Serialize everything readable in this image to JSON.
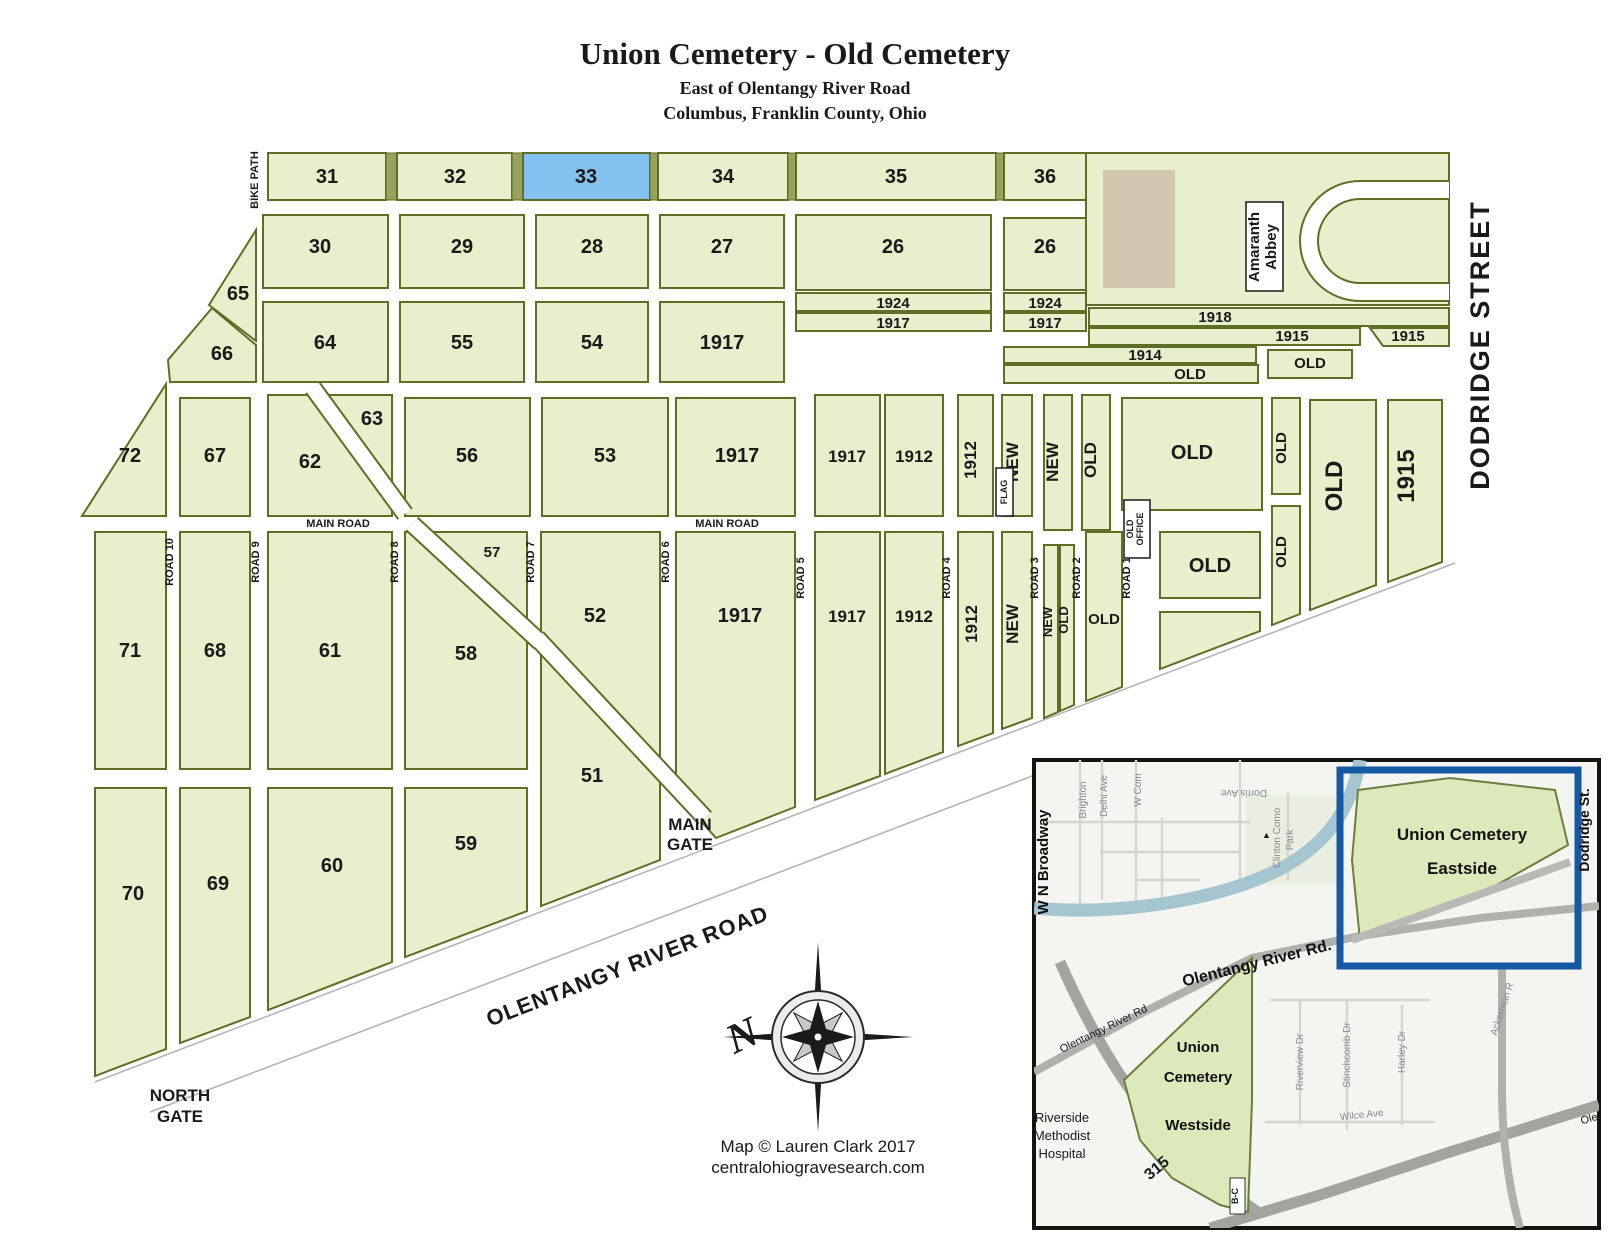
{
  "title": "Union Cemetery - Old Cemetery",
  "subtitle_line1": "East of Olentangy River Road",
  "subtitle_line2": "Columbus, Franklin County, Ohio",
  "colors": {
    "section_fill": "#e9efcd",
    "section_border": "#5f6e24",
    "separator_fill": "#97a35c",
    "highlight_fill": "#85c1ee",
    "building_fill": "#d4c7b2",
    "road_line_gray": "#b5b5b5",
    "inset_frame": "#141414",
    "inset_highlight_blue": "#1559a5",
    "river_blue": "#a5c6d1",
    "inset_green": "#dce9ba"
  },
  "sections": {
    "s26": "26",
    "s27": "27",
    "s28": "28",
    "s29": "29",
    "s30": "30",
    "s31": "31",
    "s32": "32",
    "s33": "33",
    "s34": "34",
    "s35": "35",
    "s36": "36",
    "s51": "51",
    "s52": "52",
    "s53": "53",
    "s54": "54",
    "s55": "55",
    "s56": "56",
    "s57": "57",
    "s58": "58",
    "s59": "59",
    "s60": "60",
    "s61": "61",
    "s62": "62",
    "s63": "63",
    "s64": "64",
    "s65": "65",
    "s66": "66",
    "s67": "67",
    "s68": "68",
    "s69": "69",
    "s70": "70",
    "s71": "71",
    "s72": "72",
    "y1912": "1912",
    "y1914": "1914",
    "y1915": "1915",
    "y1917": "1917",
    "y1918": "1918",
    "y1924": "1924",
    "old": "OLD",
    "new": "NEW",
    "flag": "FLAG",
    "office_line1": "OLD",
    "office_line2": "OFFICE"
  },
  "roads": {
    "main_road": "MAIN ROAD",
    "road1": "ROAD 1",
    "road2": "ROAD 2",
    "road3": "ROAD 3",
    "road4": "ROAD 4",
    "road5": "ROAD 5",
    "road6": "ROAD 6",
    "road7": "ROAD 7",
    "road8": "ROAD 8",
    "road9": "ROAD 9",
    "road10": "ROAD 10",
    "bike_path": "BIKE PATH",
    "dodridge_street": "DODRIDGE STREET",
    "olentangy_river_road": "OLENTANGY RIVER ROAD"
  },
  "gates": {
    "main_gate_line1": "MAIN",
    "main_gate_line2": "GATE",
    "north_gate_line1": "NORTH",
    "north_gate_line2": "GATE"
  },
  "landmarks": {
    "abbey_line1": "Amaranth",
    "abbey_line2": "Abbey"
  },
  "compass": {
    "north": "N"
  },
  "credits": {
    "line1": "Map © Lauren Clark 2017",
    "line2": "centralohiogravesearch.com"
  },
  "inset": {
    "eastside_line1": "Union Cemetery",
    "eastside_line2": "Eastside",
    "westside_line1": "Union",
    "westside_line2": "Cemetery",
    "westside_line3": "Westside",
    "hospital_line1": "Riverside",
    "hospital_line2": "Methodist",
    "hospital_line3": "Hospital",
    "streets": {
      "wn_broadway": "W N Broadway",
      "brighton": "Brighton",
      "delhi_ave": "Delhi Ave",
      "w_com": "W Com",
      "dorris_ave": "Dorris Ave",
      "clinton_line1": "Clinton Como",
      "clinton_line2": "Park",
      "dodridge_st": "Dodridge St.",
      "olentangy_bold": "Olentangy River Rd.",
      "olentangy_small": "Olentangy River Rd",
      "ackerman": "Ackerman R",
      "riverview": "Riverview Dr",
      "stinchcomb": "Stinchcomb Dr",
      "harley": "Harley Dr",
      "wilce": "Wilce Ave",
      "route_315": "315",
      "exit_bc": "B-C",
      "ole": "Ole"
    }
  }
}
